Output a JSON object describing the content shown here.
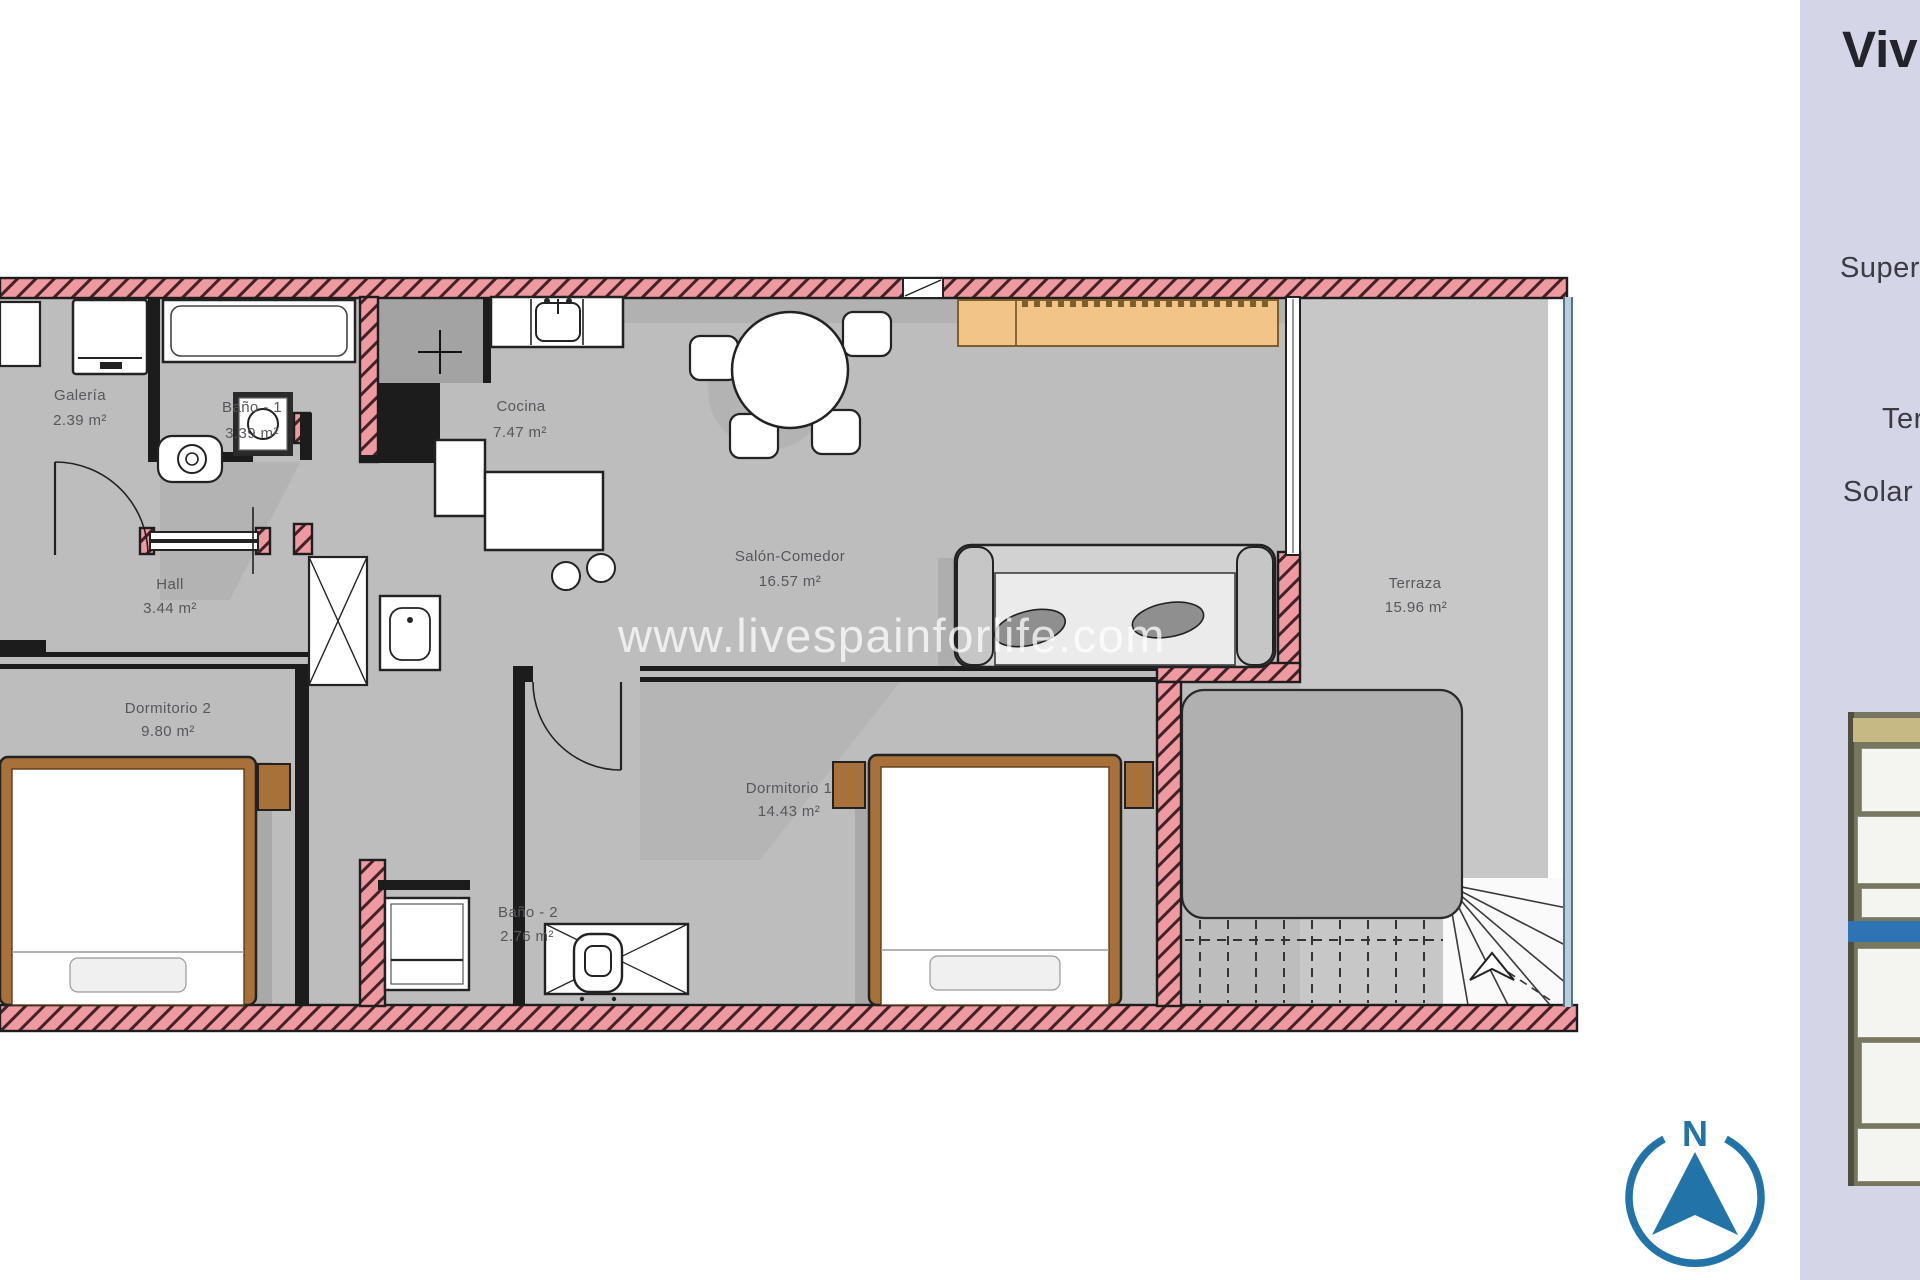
{
  "watermark": {
    "text": "www.livespainforlife.com"
  },
  "plan": {
    "rooms": [
      {
        "name": "Galería",
        "area": "2.39 m²"
      },
      {
        "name": "Baño - 1",
        "area": "3.39 m²"
      },
      {
        "name": "Cocina",
        "area": "7.47 m²"
      },
      {
        "name": "Salón-Comedor",
        "area": "16.57 m²"
      },
      {
        "name": "Hall",
        "area": "3.44 m²"
      },
      {
        "name": "Dormitorio 2",
        "area": "9.80 m²"
      },
      {
        "name": "Dormitorio 1",
        "area": "14.43 m²"
      },
      {
        "name": "Baño - 2",
        "area": "2.76 m²"
      },
      {
        "name": "Terraza",
        "area": "15.96 m²"
      }
    ]
  },
  "sidebar": {
    "title": "Vivi",
    "row1": "Super",
    "row2": "Ter",
    "row3": "Solar"
  },
  "compass": {
    "north": "N"
  },
  "colors": {
    "wall_pink": "#ef9aa1",
    "wall_hatch": "#432227",
    "floor_gray": "#bdbdbd",
    "terrace_gray": "#c7c7c7",
    "panel_lavender": "#d5d5e8",
    "thumbnail_band_blue": "#2e74b4",
    "sideboard_orange": "#f3c488",
    "furniture_wood": "#a9713a",
    "compass_blue": "#2273a8"
  }
}
